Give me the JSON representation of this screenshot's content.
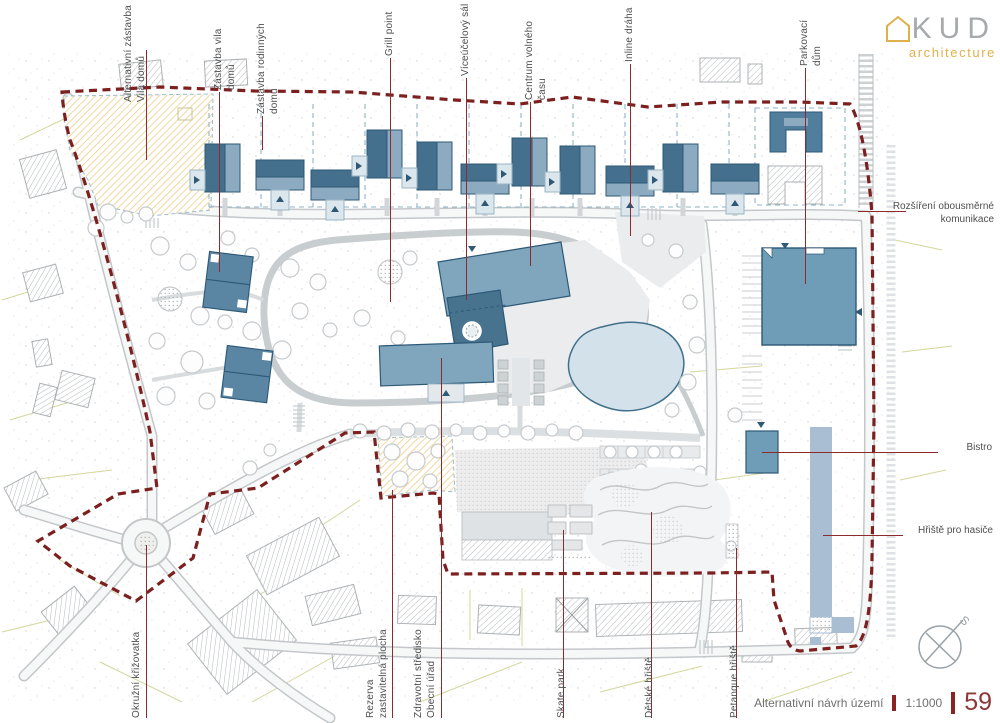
{
  "logo": {
    "kud": "KUD",
    "architecture": "architecture"
  },
  "labels": {
    "top": [
      {
        "text": "Alternativní zástavba\nVila domů"
      },
      {
        "text": "Zástavba vila domů"
      },
      {
        "text": "Zástavba rodinných domů"
      },
      {
        "text": "Grill point"
      },
      {
        "text": "Víceúčelový sál"
      },
      {
        "text": "Centrum volného času"
      },
      {
        "text": "Inline dráha"
      },
      {
        "text": "Parkovací dům"
      }
    ],
    "right": [
      {
        "text": "Rozšíření obousměrné\nkomunikace"
      },
      {
        "text": "Bistro"
      },
      {
        "text": "Hřiště pro hasiče"
      }
    ],
    "bottom": [
      {
        "text": "Okružní křižovatka"
      },
      {
        "text": "Rezerva\nzastavitelná plocha"
      },
      {
        "text": "Zdravotní středisko\nObecní úřad"
      },
      {
        "text": "Skate park"
      },
      {
        "text": "Dětské hřiště"
      },
      {
        "text": "Petanque hřiště"
      }
    ]
  },
  "titleblock": {
    "title": "Alternativní návrh území",
    "scale": "1:1000",
    "page": "59"
  },
  "compass": {
    "letter": "S"
  },
  "colors": {
    "boundary": "#7c1f1f",
    "leader": "#8b2b2b",
    "building_dark": "#48738f",
    "building_mid": "#5b86a3",
    "building_light": "#8cabc0",
    "parking_house": "#6f9cb6",
    "fire_field": "#a9bed2",
    "pond_fill": "#d3e1ea",
    "pond_stroke": "#41708c",
    "accent_yellow": "#dfb14a",
    "hatch_yellow": "#f0d494",
    "page_number": "#8c3838"
  }
}
